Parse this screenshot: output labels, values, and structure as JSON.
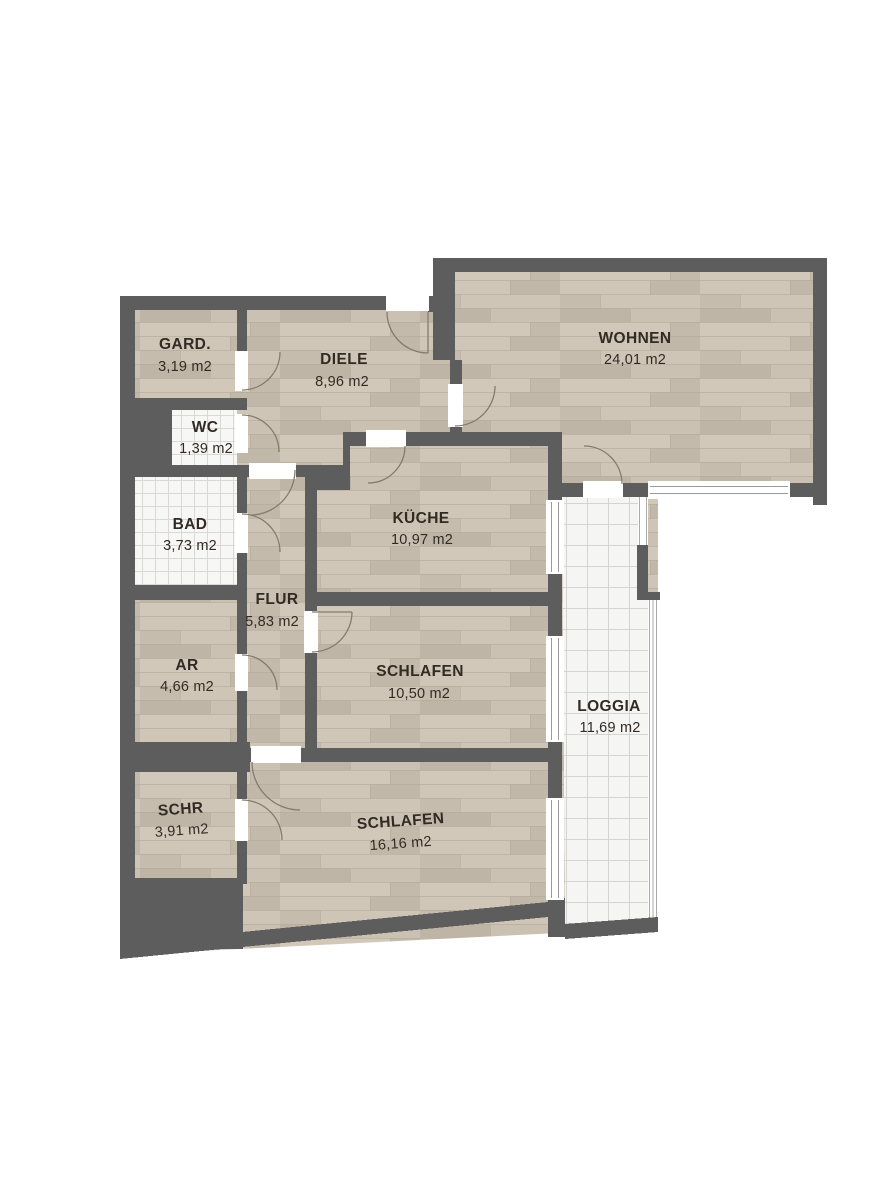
{
  "plan": {
    "title": "Apartment floor plan",
    "unit_suffix": "m2",
    "rooms": [
      {
        "id": "gard",
        "name": "GARD.",
        "area": "3,19 m2"
      },
      {
        "id": "diele",
        "name": "DIELE",
        "area": "8,96 m2"
      },
      {
        "id": "wohnen",
        "name": "WOHNEN",
        "area": "24,01 m2"
      },
      {
        "id": "wc",
        "name": "WC",
        "area": "1,39 m2"
      },
      {
        "id": "bad",
        "name": "BAD",
        "area": "3,73 m2"
      },
      {
        "id": "kueche",
        "name": "KÜCHE",
        "area": "10,97 m2"
      },
      {
        "id": "flur",
        "name": "FLUR",
        "area": "5,83 m2"
      },
      {
        "id": "ar",
        "name": "AR",
        "area": "4,66 m2"
      },
      {
        "id": "schlafen1",
        "name": "SCHLAFEN",
        "area": "10,50 m2"
      },
      {
        "id": "loggia",
        "name": "LOGGIA",
        "area": "11,69 m2"
      },
      {
        "id": "schr",
        "name": "SCHR",
        "area": "3,91 m2"
      },
      {
        "id": "schlafen2",
        "name": "SCHLAFEN",
        "area": "16,16 m2"
      }
    ],
    "colors": {
      "wall": "#5d5d5d",
      "wood": "#c9c0b2",
      "tile": "#f6f6f5",
      "label": "#322b24"
    }
  }
}
